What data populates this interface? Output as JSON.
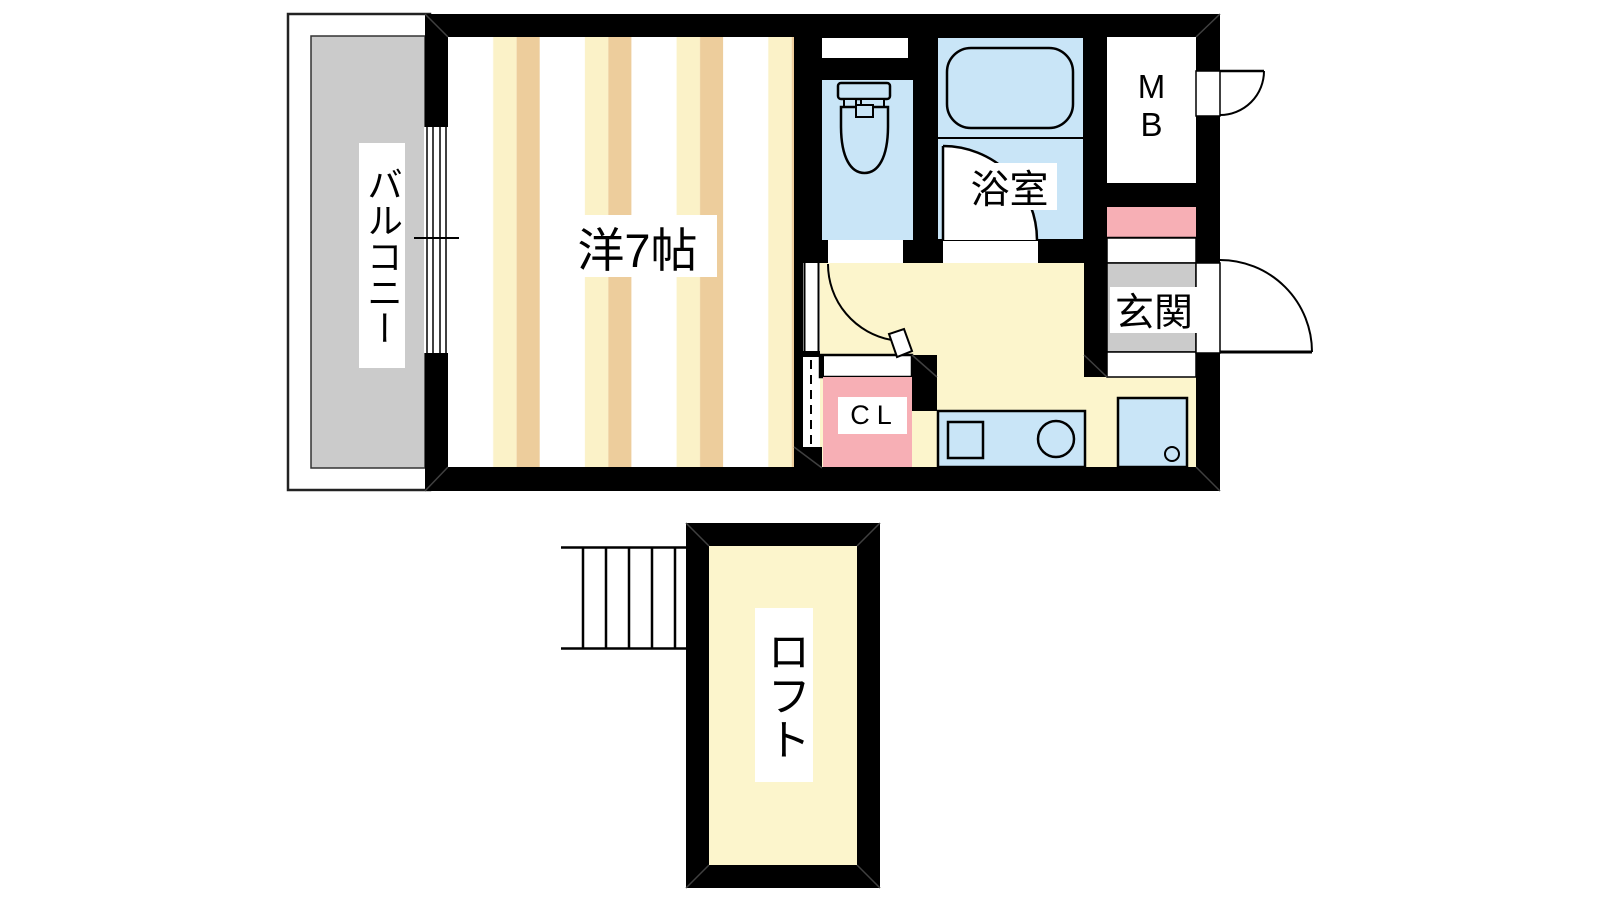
{
  "document": {
    "type": "apartment-floor-plan",
    "background": "#ffffff"
  },
  "labels": {
    "balcony": "バルコニー",
    "western_room": "洋7帖",
    "bathroom": "浴室",
    "meter_box": {
      "line1": "M",
      "line2": "B"
    },
    "entrance": "玄関",
    "closet": "CL",
    "loft": "ロフト"
  },
  "colors": {
    "wall": "#000000",
    "water_blue": "#c9e5f7",
    "floor_yellow": "#fcf5cc",
    "pink": "#f7afb5",
    "gray_floor": "#cbcbcb",
    "stripe_cream": "#fbf2c8",
    "stripe_tan": "#edcd9c",
    "white": "#ffffff",
    "line": "#000000",
    "seam": "#404040",
    "balcony_outline": "#222222"
  },
  "icons": {
    "toilet": "toilet-plan-symbol",
    "bathtub": "rounded-rect-tub",
    "stove": "square",
    "sink": "circle",
    "washing_machine": "square-with-knob",
    "stairs": "step-lines",
    "entry_doors": "quarter-circle-swing",
    "window": "sliding-window-lines",
    "closet_opening": "dashed-line"
  }
}
